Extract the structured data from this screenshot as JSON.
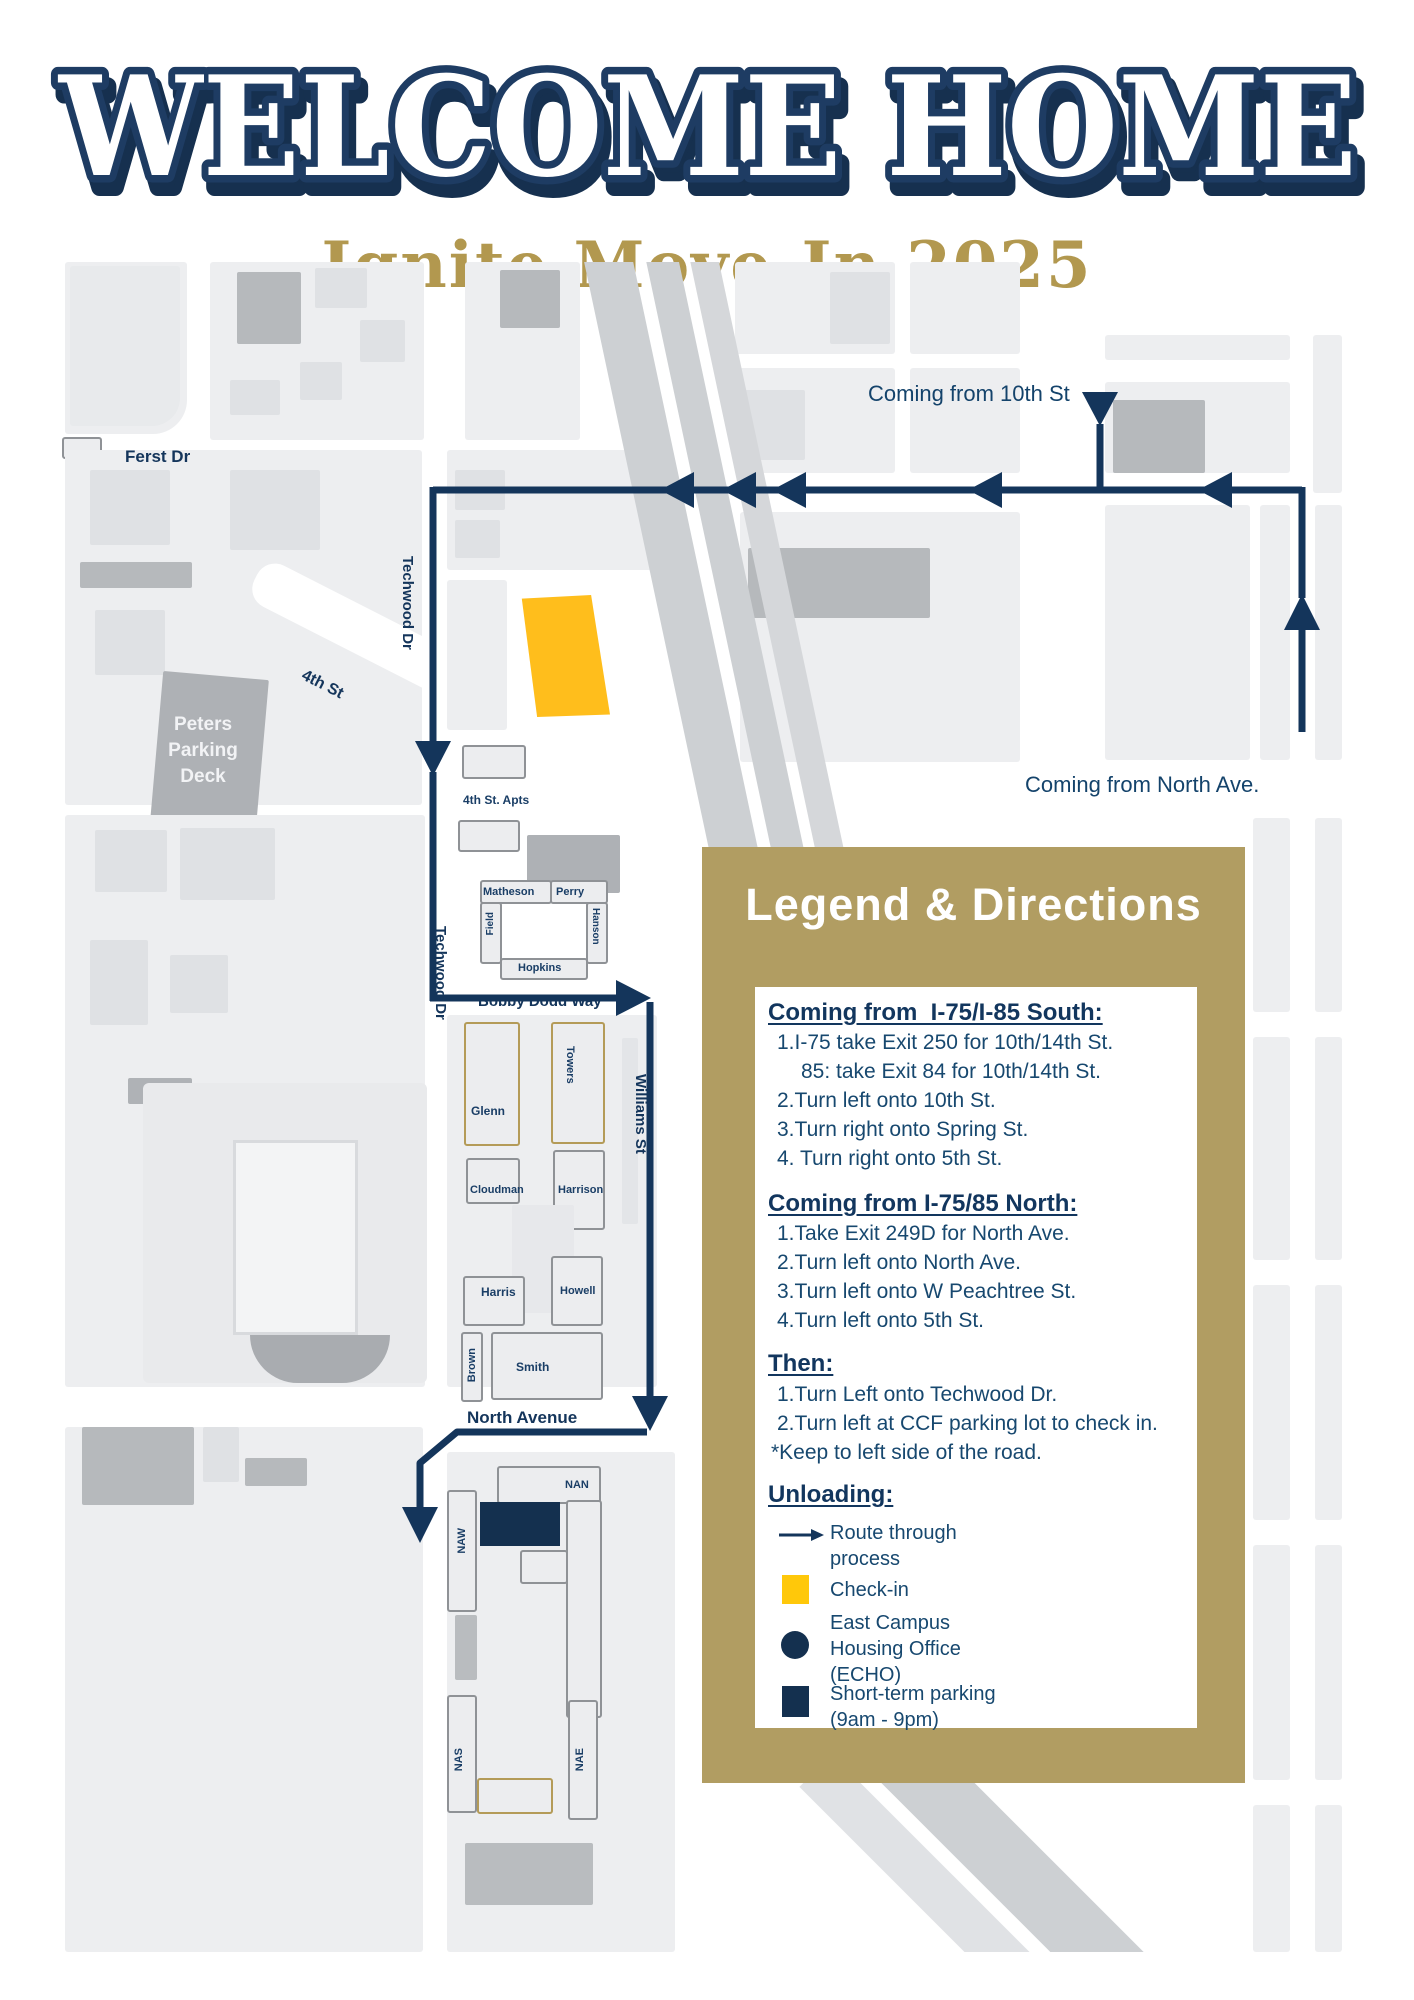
{
  "header": {
    "title": "WELCOME HOME",
    "subtitle": "Ignite Move-In 2025"
  },
  "map": {
    "route_labels": {
      "coming_from_10th": "Coming from 10th St",
      "coming_from_north": "Coming from North Ave."
    },
    "streets": {
      "ferst_dr": "Ferst Dr",
      "techwood_dr": "Techwood Dr",
      "fourth_st": "4th St",
      "bobby_dodd_way": "Bobby Dodd Way",
      "williams_st": "Williams St",
      "north_avenue": "North Avenue"
    },
    "buildings": {
      "peters": "Peters Parking Deck",
      "fourth_st_apts": "4th St. Apts",
      "matheson": "Matheson",
      "perry": "Perry",
      "field": "Field",
      "hanson": "Hanson",
      "hopkins": "Hopkins",
      "glenn": "Glenn",
      "towers": "Towers",
      "cloudman": "Cloudman",
      "harrison": "Harrison",
      "harris": "Harris",
      "howell": "Howell",
      "brown": "Brown",
      "smith": "Smith",
      "nan": "NAN",
      "naw": "NAW",
      "nas": "NAS",
      "nae": "NAE"
    }
  },
  "legend": {
    "title": "Legend & Directions",
    "south": {
      "heading": "Coming from  I-75/I-85 South:",
      "lines": [
        {
          "num": "1.",
          "text": "I-75 take Exit 250 for 10th/14th St."
        },
        {
          "num": "",
          "text": "85: take Exit 84 for 10th/14th St."
        },
        {
          "num": "2.",
          "text": "Turn left onto 10th St."
        },
        {
          "num": "3.",
          "text": "Turn right onto Spring St."
        },
        {
          "num": "4.",
          "text": " Turn right onto 5th St."
        }
      ]
    },
    "north": {
      "heading": "Coming from I-75/85 North:",
      "lines": [
        {
          "num": "1.",
          "text": "Take Exit 249D for North Ave."
        },
        {
          "num": "2.",
          "text": "Turn left onto North Ave."
        },
        {
          "num": "3.",
          "text": "Turn left onto W Peachtree St."
        },
        {
          "num": "4.",
          "text": "Turn left onto 5th St."
        }
      ]
    },
    "then": {
      "heading": "Then:",
      "lines": [
        {
          "num": "1.",
          "text": "Turn Left onto Techwood Dr."
        },
        {
          "num": "2.",
          "text": "Turn left at CCF parking lot to check in."
        },
        {
          "num": "",
          "text": "*Keep to left side of the road."
        }
      ]
    },
    "unloading": {
      "heading": "Unloading:",
      "items": [
        {
          "icon": "route-arrow-icon",
          "label": "Route through\nprocess"
        },
        {
          "icon": "check-in-swatch",
          "label": "Check-in"
        },
        {
          "icon": "echo-dot-icon",
          "label": "East Campus\nHousing Office\n(ECHO)"
        },
        {
          "icon": "parking-swatch",
          "label": "Short-term parking\n(9am - 9pm)"
        }
      ]
    }
  },
  "colors": {
    "navy": "#14355B",
    "title_outline": "#1E3C63",
    "gold_panel": "#B19D62",
    "subtitle_gold": "#B2984F",
    "checkin_yellow": "#FFBE1C",
    "legend_yellow": "#FFC80A",
    "parking_navy": "#14304F",
    "block_gray": "#EDEEF0",
    "building_gray": "#B6B9BC",
    "highway_gray": "#CDD0D3"
  }
}
